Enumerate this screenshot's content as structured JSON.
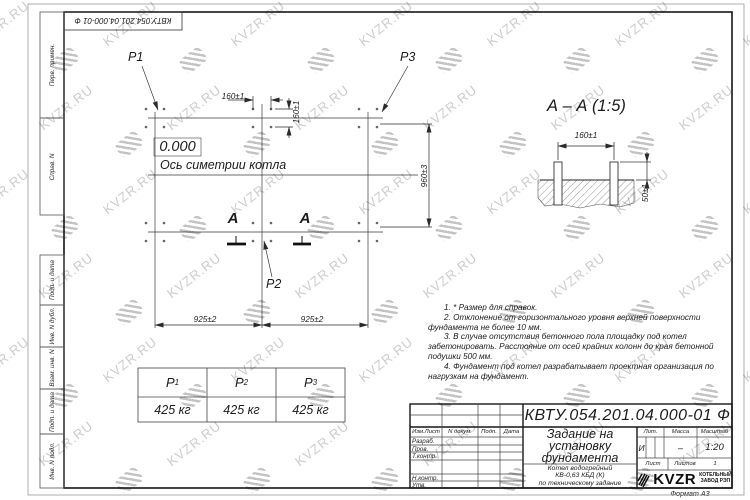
{
  "sheet": {
    "format_label": "Формат А3",
    "watermark_text": "KVZR.RU",
    "doc_number_stamp": "КВТУ.054.201.04.000-01 Ф"
  },
  "margin_stamps": [
    "Перв. примен.",
    "Справ. N",
    "Подп. и дата",
    "Инв. N дубл.",
    "Взам. инв. N",
    "Подп. и дата",
    "Инв. N подл."
  ],
  "plan": {
    "elevation": "0.000",
    "axis_label": "Ось симетрии котла",
    "p1": "P1",
    "p2": "P2",
    "p3": "P3",
    "section_letter": "А",
    "dims": {
      "d160h": "160±1",
      "d160v": "160±1",
      "d960": "960±3",
      "d925a": "925±2",
      "d925b": "925±2"
    }
  },
  "section": {
    "title": "А – А (1:5)",
    "dims": {
      "d160": "160±1",
      "d50": "50±1"
    }
  },
  "loads_table": {
    "headers": [
      {
        "p": "P",
        "sub": "1"
      },
      {
        "p": "P",
        "sub": "2"
      },
      {
        "p": "P",
        "sub": "3"
      }
    ],
    "values": [
      "425 кг",
      "425 кг",
      "425 кг"
    ]
  },
  "notes": [
    "1. * Размер для справок.",
    "2. Отклонение от горизонтального уровня верхней поверхности фундамента не более 10 мм.",
    "3. В случае отсутствия бетонного пола площадку под котел забетонировать. Расстояние от осей крайних колонн до края бетонной подушки 500 мм.",
    "4. Фундамент под котел разрабатывает проектная организация по нагрузкам на фундамент."
  ],
  "title_block": {
    "doc_number": "КВТУ.054.201.04.000-01 Ф",
    "title_lines": [
      "Задание на",
      "установку",
      "фундамента"
    ],
    "subtitle_lines": [
      "Котел водогрейный",
      "КВ-0,63 КБД (К)",
      "по техническому задание"
    ],
    "header_cells": [
      "Изм.Лист",
      "N докум.",
      "Подп.",
      "Дата"
    ],
    "row_labels": [
      "Разраб.",
      "Пров.",
      "Т.контр.",
      "Н.контр.",
      "Утв."
    ],
    "lit_label": "Лит.",
    "mass_label": "Масса",
    "scale_label": "Масштаб",
    "lit_value": "И",
    "mass_value": "–",
    "scale_value": "1:20",
    "sheet_label": "Лист",
    "sheets_label": "Листов",
    "sheets_value": "1",
    "company_name": "KVZR",
    "company_tagline_lines": [
      "КОТЕЛЬНЫЙ",
      "ЗАВОД РЭП"
    ]
  }
}
